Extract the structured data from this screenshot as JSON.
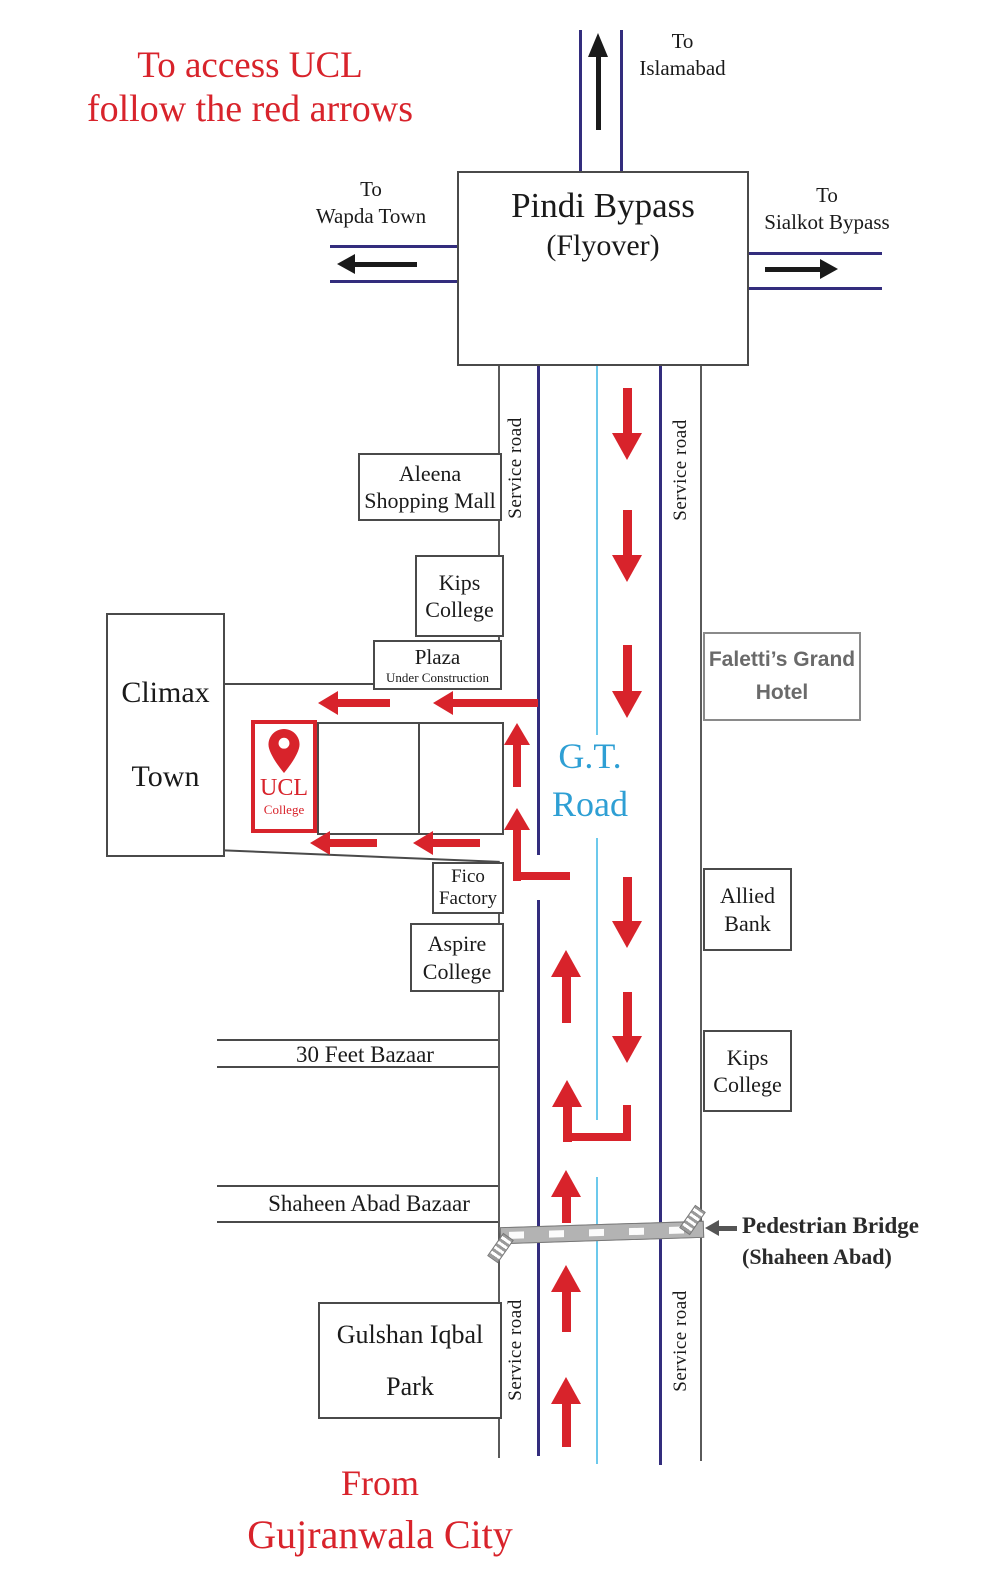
{
  "colors": {
    "red": "#d8232b",
    "navy": "#332d7d",
    "cyan": "#6cc9ec",
    "gt_blue": "#2e9fd4",
    "outline": "#5a5a5a",
    "box_border": "#4a4a4a",
    "black": "#1a1a1a",
    "hotel_text": "#6a6a6a",
    "bridge_gray": "#b3b3b3",
    "bridge_dark": "#555555"
  },
  "header": {
    "line1": "To access UCL",
    "line2": "follow the red arrows"
  },
  "flyover": {
    "title": "Pindi Bypass",
    "subtitle": "(Flyover)"
  },
  "junctions": {
    "islamabad": {
      "to": "To",
      "name": "Islamabad"
    },
    "wapda": {
      "to": "To",
      "name": "Wapda Town"
    },
    "sialkot": {
      "to": "To",
      "name": "Sialkot Bypass"
    }
  },
  "road": {
    "gt1": "G.T.",
    "gt2": "Road",
    "service": "Service road"
  },
  "places": {
    "aleena": {
      "l1": "Aleena",
      "l2": "Shopping Mall"
    },
    "kips_left": {
      "l1": "Kips",
      "l2": "College"
    },
    "plaza": {
      "l1": "Plaza",
      "l2": "Under Construction"
    },
    "climax": {
      "l1": "Climax",
      "l2": "Town"
    },
    "ucl": {
      "l1": "UCL",
      "l2": "College"
    },
    "fico": {
      "l1": "Fico",
      "l2": "Factory"
    },
    "aspire": {
      "l1": "Aspire",
      "l2": "College"
    },
    "faletti": {
      "l1": "Faletti’s Grand",
      "l2": "Hotel"
    },
    "allied": {
      "l1": "Allied",
      "l2": "Bank"
    },
    "kips_right": {
      "l1": "Kips",
      "l2": "College"
    },
    "bazaar30": "30 Feet Bazaar",
    "shaheen": "Shaheen Abad Bazaar",
    "gulshan": {
      "l1": "Gulshan Iqbal",
      "l2": "Park"
    },
    "bridge": {
      "l1": "Pedestrian Bridge",
      "l2": "(Shaheen Abad)"
    }
  },
  "footer": {
    "line1": "From",
    "line2": "Gujranwala City"
  },
  "shapes": {
    "lines": [
      {
        "x": 498,
        "y": 362,
        "w": 2,
        "h": 323,
        "c": "outline"
      },
      {
        "x": 498,
        "y": 862,
        "w": 2,
        "h": 596,
        "c": "outline"
      },
      {
        "x": 537,
        "y": 362,
        "w": 3,
        "h": 493,
        "c": "navy"
      },
      {
        "x": 537,
        "y": 900,
        "w": 3,
        "h": 556,
        "c": "navy"
      },
      {
        "x": 596,
        "y": 362,
        "w": 2,
        "h": 373,
        "c": "cyan"
      },
      {
        "x": 596,
        "y": 838,
        "w": 2,
        "h": 282,
        "c": "cyan"
      },
      {
        "x": 596,
        "y": 1177,
        "w": 2,
        "h": 287,
        "c": "cyan"
      },
      {
        "x": 659,
        "y": 362,
        "w": 3,
        "h": 1103,
        "c": "navy"
      },
      {
        "x": 700,
        "y": 362,
        "w": 2,
        "h": 1099,
        "c": "outline"
      },
      {
        "x": 579,
        "y": 30,
        "w": 3,
        "h": 141,
        "c": "navy"
      },
      {
        "x": 620,
        "y": 30,
        "w": 3,
        "h": 141,
        "c": "navy"
      },
      {
        "x": 330,
        "y": 245,
        "w": 127,
        "h": 3,
        "c": "navy"
      },
      {
        "x": 330,
        "y": 280,
        "w": 127,
        "h": 3,
        "c": "navy"
      },
      {
        "x": 745,
        "y": 252,
        "w": 137,
        "h": 3,
        "c": "navy"
      },
      {
        "x": 745,
        "y": 287,
        "w": 137,
        "h": 3,
        "c": "navy"
      },
      {
        "x": 221,
        "y": 683,
        "w": 277,
        "h": 2,
        "c": "box_border"
      },
      {
        "x": 217,
        "y": 1039,
        "w": 281,
        "h": 2,
        "c": "box_border"
      },
      {
        "x": 217,
        "y": 1066,
        "w": 281,
        "h": 2,
        "c": "box_border"
      },
      {
        "x": 217,
        "y": 1185,
        "w": 281,
        "h": 2,
        "c": "box_border"
      },
      {
        "x": 217,
        "y": 1221,
        "w": 281,
        "h": 2,
        "c": "box_border"
      }
    ],
    "slanted": [
      {
        "x": 215,
        "y": 849,
        "len": 285,
        "deg": 2.4,
        "t": 2,
        "c": "box_border"
      }
    ],
    "segments": [
      {
        "x": 563,
        "y": 1133,
        "w": 68,
        "h": 8,
        "c": "red"
      },
      {
        "x": 623,
        "y": 1105,
        "w": 8,
        "h": 36,
        "c": "red"
      },
      {
        "x": 513,
        "y": 872,
        "w": 57,
        "h": 8,
        "c": "red"
      }
    ],
    "arrows": [
      {
        "dir": "down",
        "x": 627,
        "y": 460,
        "len": 72,
        "sw": 9,
        "hw": 30,
        "hh": 27,
        "c": "red"
      },
      {
        "dir": "down",
        "x": 627,
        "y": 582,
        "len": 72,
        "sw": 9,
        "hw": 30,
        "hh": 27,
        "c": "red"
      },
      {
        "dir": "down",
        "x": 627,
        "y": 718,
        "len": 73,
        "sw": 9,
        "hw": 30,
        "hh": 27,
        "c": "red"
      },
      {
        "dir": "down",
        "x": 627,
        "y": 948,
        "len": 71,
        "sw": 9,
        "hw": 30,
        "hh": 27,
        "c": "red"
      },
      {
        "dir": "down",
        "x": 627,
        "y": 1063,
        "len": 71,
        "sw": 9,
        "hw": 30,
        "hh": 27,
        "c": "red"
      },
      {
        "dir": "up",
        "x": 566,
        "y": 950,
        "len": 73,
        "sw": 9,
        "hw": 30,
        "hh": 27,
        "c": "red"
      },
      {
        "dir": "up",
        "x": 567,
        "y": 1080,
        "len": 62,
        "sw": 9,
        "hw": 30,
        "hh": 27,
        "c": "red"
      },
      {
        "dir": "up",
        "x": 566,
        "y": 1170,
        "len": 53,
        "sw": 9,
        "hw": 30,
        "hh": 27,
        "c": "red"
      },
      {
        "dir": "up",
        "x": 566,
        "y": 1265,
        "len": 67,
        "sw": 9,
        "hw": 30,
        "hh": 27,
        "c": "red"
      },
      {
        "dir": "up",
        "x": 566,
        "y": 1377,
        "len": 70,
        "sw": 9,
        "hw": 30,
        "hh": 27,
        "c": "red"
      },
      {
        "dir": "up",
        "x": 517,
        "y": 723,
        "len": 64,
        "sw": 8,
        "hw": 26,
        "hh": 22,
        "c": "red"
      },
      {
        "dir": "up",
        "x": 517,
        "y": 808,
        "len": 73,
        "sw": 8,
        "hw": 26,
        "hh": 22,
        "c": "red"
      },
      {
        "dir": "left",
        "x": 433,
        "y": 703,
        "len": 105,
        "sw": 8,
        "hw": 24,
        "hh": 20,
        "c": "red"
      },
      {
        "dir": "left",
        "x": 318,
        "y": 703,
        "len": 72,
        "sw": 8,
        "hw": 24,
        "hh": 20,
        "c": "red"
      },
      {
        "dir": "left",
        "x": 413,
        "y": 843,
        "len": 67,
        "sw": 8,
        "hw": 24,
        "hh": 20,
        "c": "red"
      },
      {
        "dir": "left",
        "x": 310,
        "y": 843,
        "len": 67,
        "sw": 8,
        "hw": 24,
        "hh": 20,
        "c": "red"
      },
      {
        "dir": "up",
        "x": 598,
        "y": 33,
        "len": 97,
        "sw": 5,
        "hw": 20,
        "hh": 24,
        "c": "black"
      },
      {
        "dir": "left",
        "x": 337,
        "y": 264,
        "len": 80,
        "sw": 5,
        "hw": 20,
        "hh": 18,
        "c": "black"
      },
      {
        "dir": "right",
        "x": 838,
        "y": 269,
        "len": 73,
        "sw": 5,
        "hw": 20,
        "hh": 18,
        "c": "black"
      },
      {
        "dir": "left",
        "x": 705,
        "y": 1228,
        "len": 32,
        "sw": 5,
        "hw": 16,
        "hh": 14,
        "c": "bridge_dark"
      }
    ]
  }
}
